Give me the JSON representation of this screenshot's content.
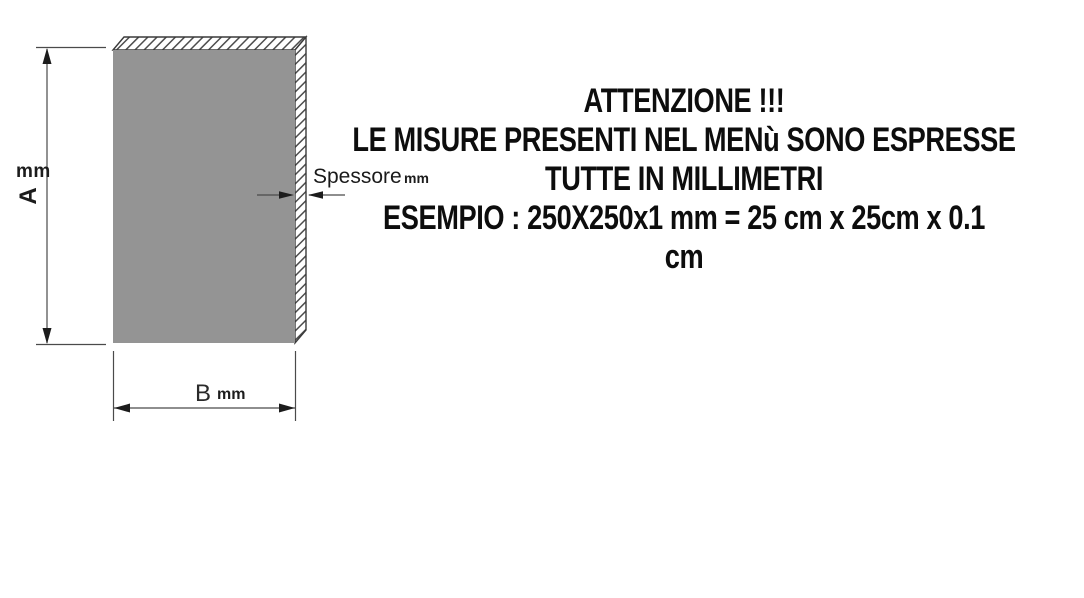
{
  "figure": {
    "plate": {
      "face_color": "#949494",
      "outline_color": "#3a3a3a",
      "hatch_color": "#4d4d4d"
    },
    "dimension_a": {
      "label": "A",
      "unit": "mm"
    },
    "dimension_b": {
      "label": "B",
      "unit": "mm"
    },
    "thickness": {
      "label": "Spessore",
      "unit": "mm"
    }
  },
  "notice": {
    "lines": [
      "ATTENZIONE !!!",
      "LE MISURE PRESENTI NEL MENù SONO ESPRESSE",
      "TUTTE IN MILLIMETRI",
      "ESEMPIO : 250X250x1 mm = 25 cm x 25cm x 0.1",
      "cm"
    ]
  }
}
